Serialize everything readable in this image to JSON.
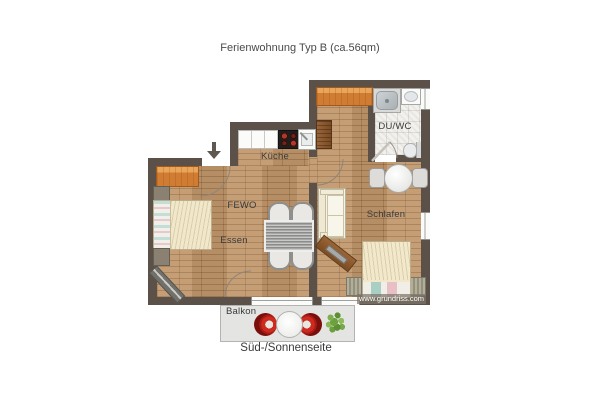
{
  "title": "Ferienwohnung Typ B (ca.56qm)",
  "labels": {
    "kitchen": "Küche",
    "living": "FEWO",
    "dining": "Essen",
    "bedroom": "Schlafen",
    "bathroom": "DU/WC",
    "balcony": "Balkon",
    "orientation": "Süd-/Sonnenseite",
    "watermark": "www.grundriss.com"
  },
  "icons": {
    "entrance_arrow": "down-arrow"
  },
  "colors": {
    "wall": "#5b5149",
    "wood_floor": "#c0966a",
    "tile_floor": "#f2f1ed",
    "balcony_floor": "#e4e4e2",
    "accent_wood": "#d07c33",
    "balcony_chair_red": "#cd2a20",
    "plant_green": "#6da03f",
    "text": "#3a3a3a"
  }
}
